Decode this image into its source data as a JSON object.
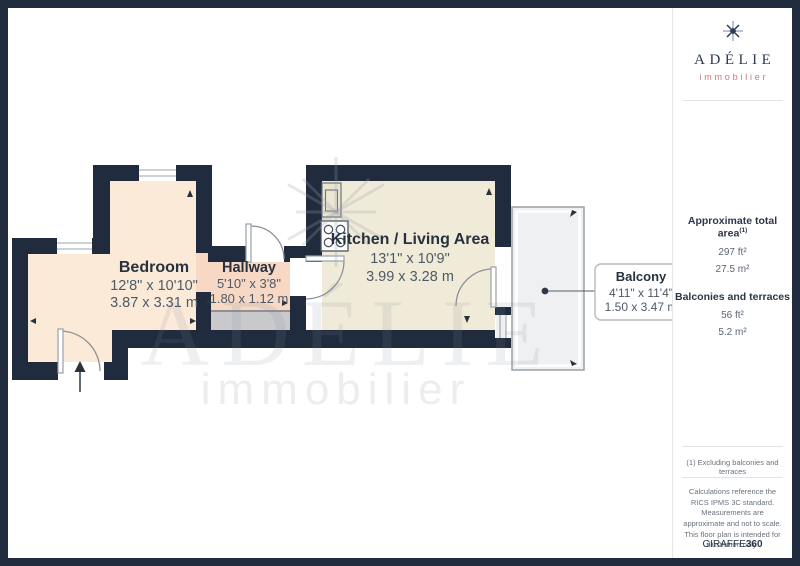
{
  "brand": {
    "name": "ADÉLIE",
    "tagline": "immobilier"
  },
  "plan": {
    "rooms": {
      "bedroom": {
        "name": "Bedroom",
        "imperial": "12'8\" x 10'10\"",
        "metric": "3.87 x 3.31 m"
      },
      "hallway": {
        "name": "Hallway",
        "imperial": "5'10\" x 3'8\"",
        "metric": "1.80 x 1.12 m"
      },
      "kitchen": {
        "name": "Kitchen / Living Area",
        "imperial": "13'1\" x 10'9\"",
        "metric": "3.99 x 3.28 m"
      },
      "balcony": {
        "name": "Balcony",
        "imperial": "4'11\" x 11'4\"",
        "metric": "1.50 x 3.47 m"
      }
    },
    "watermark": {
      "line1": "ADÉLIE",
      "line2": "immobilier"
    }
  },
  "sidebar": {
    "total_area": {
      "label": "Approximate total area",
      "footnote_ref": "(1)",
      "value_imperial": "297 ft²",
      "value_metric": "27.5 m²"
    },
    "balconies": {
      "label": "Balconies and terraces",
      "value_imperial": "56 ft²",
      "value_metric": "5.2 m²"
    },
    "footnote": "(1) Excluding balconies and terraces",
    "disclaimer": "Calculations reference the RICS IPMS 3C standard. Measurements are approximate and not to scale. This floor plan is intended for illustration only.",
    "credit_brand": "GIRAFFE",
    "credit_suffix": "360"
  },
  "colors": {
    "wall": "#202c3e",
    "bedroom_floor": "#fcead9",
    "hallway_floor": "#f6d8c4",
    "kitchen_floor": "#f0ebd8",
    "balcony_floor": "#eff0f1",
    "landing_gray": "#c9c9cb",
    "brand_navy": "#2e3852",
    "brand_rose": "#c9797f"
  }
}
